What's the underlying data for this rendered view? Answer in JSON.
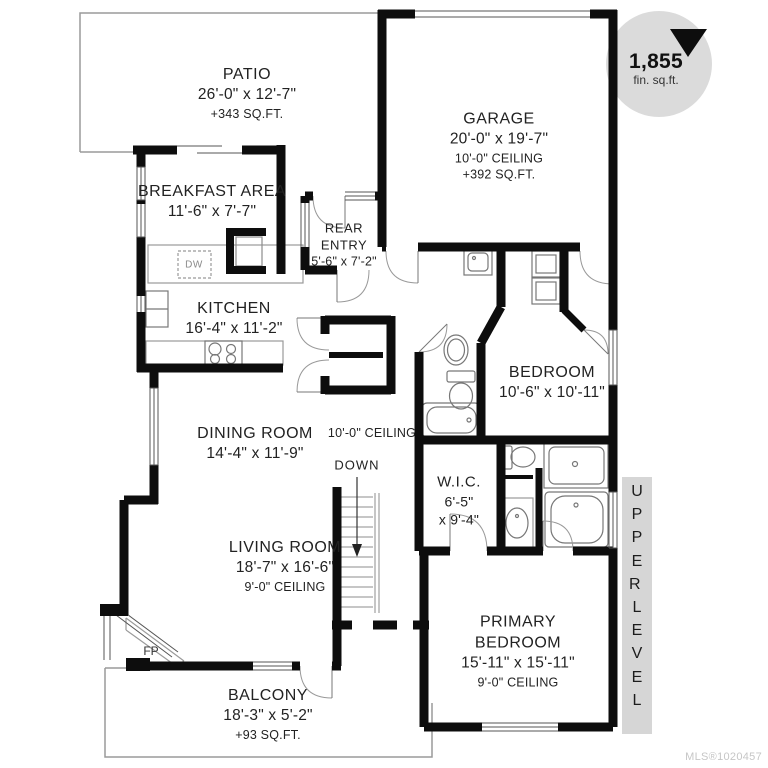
{
  "badge": {
    "value": "1,855",
    "unit": "fin. sq.ft."
  },
  "level_band": "UPPER LEVEL",
  "watermark": "MLS®1020457",
  "rooms": {
    "patio": {
      "name": "PATIO",
      "dims": "26'-0\" x 12'-7\"",
      "area": "+343 SQ.FT."
    },
    "garage": {
      "name": "GARAGE",
      "dims": "20'-0\" x 19'-7\"",
      "ceiling": "10'-0\" CEILING",
      "area": "+392 SQ.FT."
    },
    "breakfast": {
      "name": "BREAKFAST AREA",
      "dims": "11'-6\" x 7'-7\""
    },
    "rear_entry": {
      "name_line1": "REAR",
      "name_line2": "ENTRY",
      "dims": "5'-6\" x 7'-2\""
    },
    "kitchen": {
      "name": "KITCHEN",
      "dims": "16'-4\" x 11'-2\""
    },
    "bedroom": {
      "name": "BEDROOM",
      "dims": "10'-6\" x 10'-11\""
    },
    "dining": {
      "name": "DINING ROOM",
      "dims": "14'-4\" x 11'-9\""
    },
    "wic": {
      "name": "W.I.C.",
      "dims_line1": "6'-5\"",
      "dims_line2": "x 9'-4\""
    },
    "living": {
      "name": "LIVING ROOM",
      "dims": "18'-7\" x 16'-6\"",
      "ceiling": "9'-0\" CEILING"
    },
    "primary": {
      "name_line1": "PRIMARY",
      "name_line2": "BEDROOM",
      "dims": "15'-11\" x 15'-11\"",
      "ceiling": "9'-0\" CEILING"
    },
    "balcony": {
      "name": "BALCONY",
      "dims": "18'-3\" x 5'-2\"",
      "area": "+93 SQ.FT."
    }
  },
  "annotations": {
    "hall_ceiling": "10'-0\" CEILING",
    "stairs": "DOWN",
    "fireplace": "FP",
    "dishwasher": "DW"
  }
}
